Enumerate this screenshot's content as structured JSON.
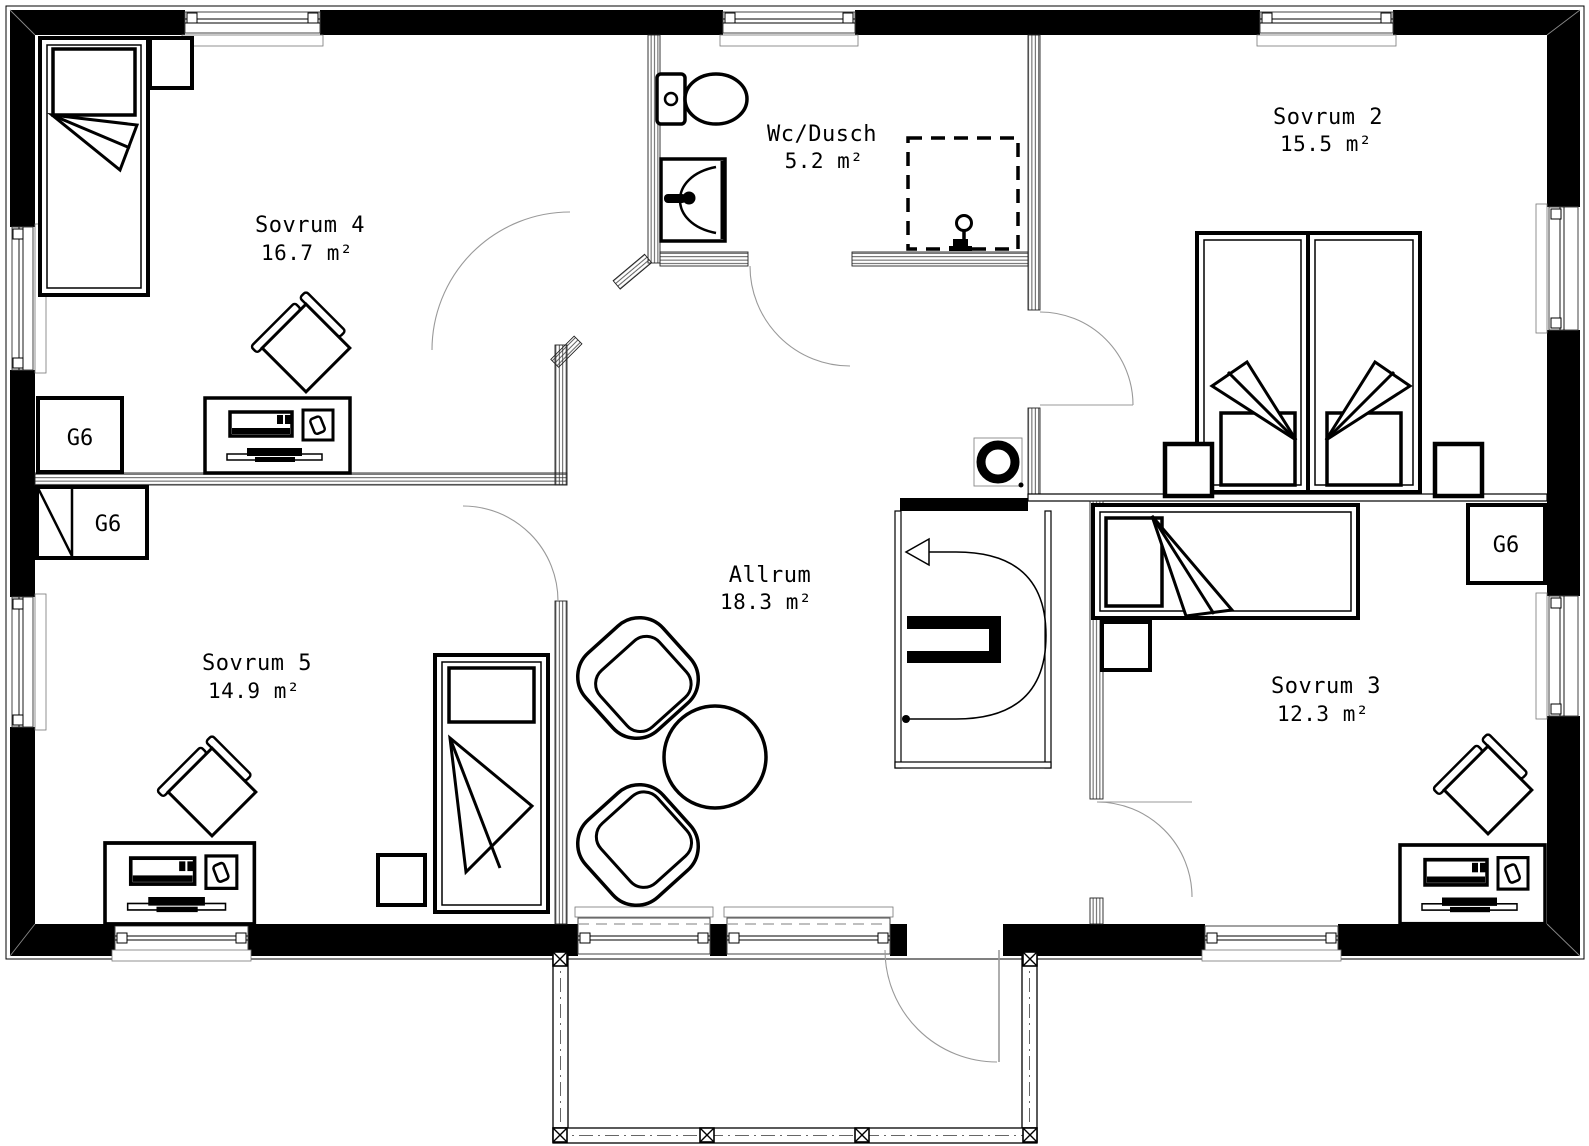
{
  "plan": {
    "title": "Floor plan – upper level",
    "rooms": [
      {
        "name": "Sovrum 4",
        "area": "16.7 m²"
      },
      {
        "name": "Wc/Dusch",
        "area": "5.2 m²"
      },
      {
        "name": "Sovrum 2",
        "area": "15.5 m²"
      },
      {
        "name": "Sovrum 5",
        "area": "14.9 m²"
      },
      {
        "name": "Allrum",
        "area": "18.3 m²"
      },
      {
        "name": "Sovrum 3",
        "area": "12.3 m²"
      }
    ],
    "wardrobe_label": "G6",
    "stair": {
      "direction_arrow": "left",
      "symbol": "u-turn-path-with-arrow"
    },
    "fixtures": [
      "toilet",
      "washbasin",
      "shower-dashed-enclosure",
      "chimney-flue"
    ],
    "furniture": [
      "single-bed",
      "double-bed",
      "nightstand",
      "desk-with-computer",
      "desk-chair",
      "armchair",
      "round-table",
      "wardrobe-g6",
      "balcony-railing"
    ],
    "colors": {
      "walls": "#000000",
      "background": "#ffffff",
      "thin_lines": "#999999"
    }
  }
}
